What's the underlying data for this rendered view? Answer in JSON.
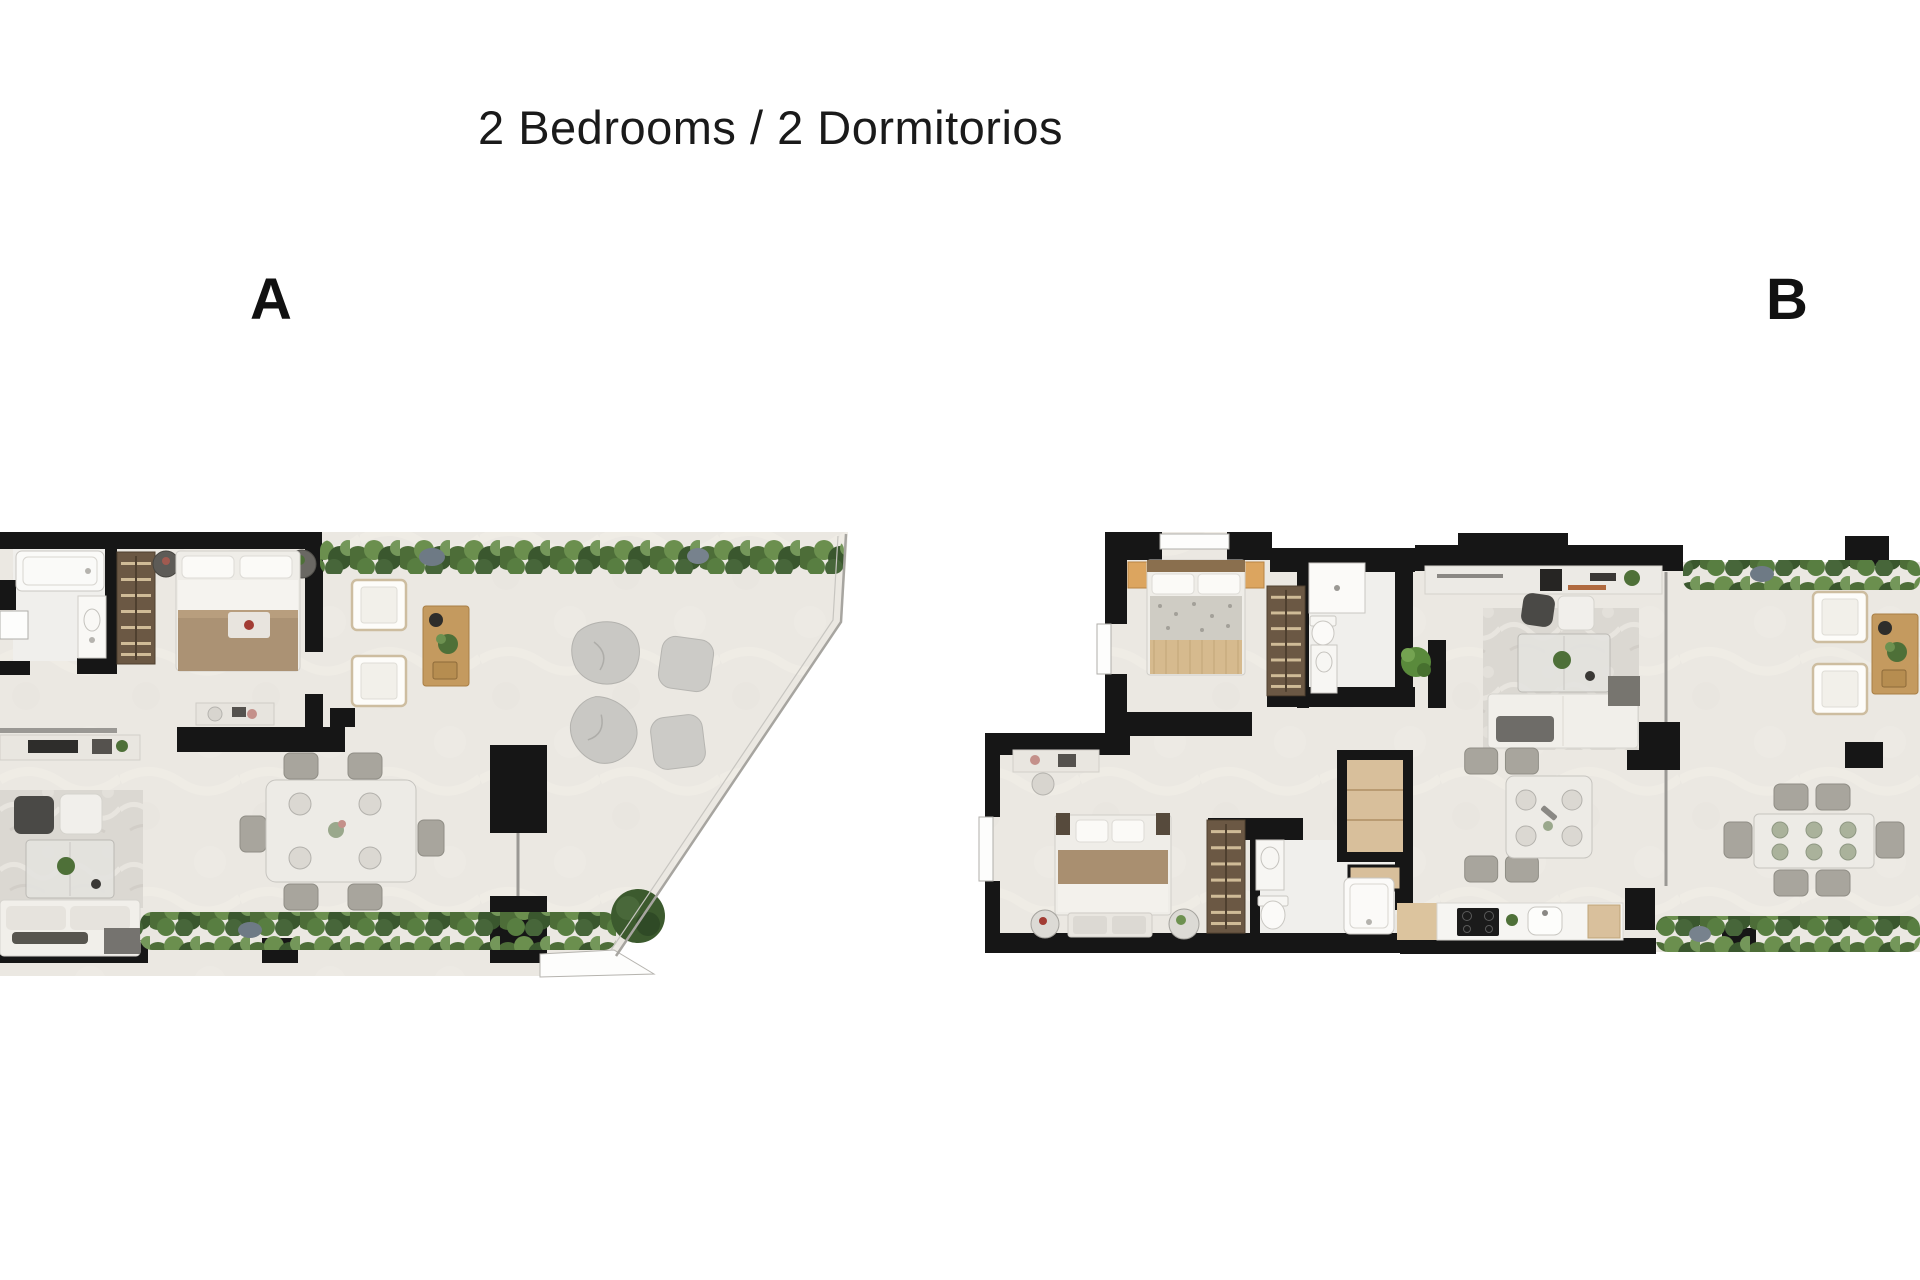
{
  "header": {
    "title": "2 Bedrooms / 2 Dormitorios"
  },
  "units": [
    {
      "label": "A",
      "name": "unit-a",
      "rooms": [
        "bathroom",
        "bedroom",
        "wardrobe",
        "living-room",
        "dining-area",
        "terrace"
      ],
      "terrace_shape": "corner terrace with angled glass railing, poufs and planters"
    },
    {
      "label": "B",
      "name": "unit-b",
      "rooms": [
        "bedroom-1",
        "bathroom-1",
        "bedroom-2",
        "bathroom-2",
        "hallway",
        "closet",
        "living-dining-room",
        "kitchen",
        "terrace"
      ],
      "terrace_shape": "side terrace with sun loungers and outdoor dining (cropped at right edge)"
    }
  ],
  "palette": {
    "background": "#ffffff",
    "wall": "#161616",
    "floor": "#ebe8e2",
    "bath_floor": "#f0efec",
    "hedge_green_dark": "#3a572e",
    "hedge_green_mid": "#4d6d38",
    "hedge_green_light": "#6b8f4e",
    "stone_gray": "#6e7a85",
    "wood": "#c49a5f",
    "wardrobe_wood": "#6b5844",
    "upholstery_white": "#f2f0ea",
    "rug_marble": "#dbd8d2",
    "pouf_gray": "#c9c8c4",
    "blanket_brown": "#ab9274",
    "chair_gray": "#a8a59d"
  }
}
